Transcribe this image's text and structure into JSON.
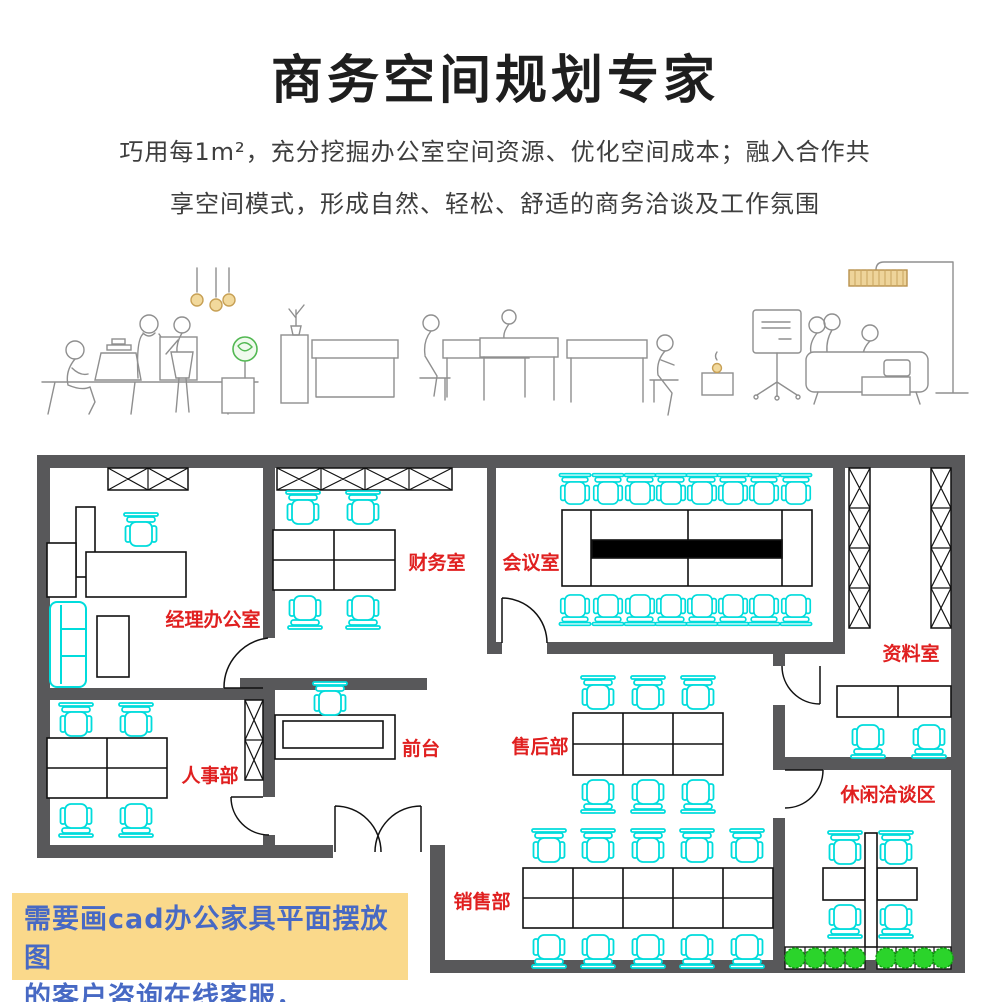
{
  "header": {
    "title": "商务空间规划专家",
    "subtitle_line1": "巧用每1m²，充分挖掘办公室空间资源、优化空间成本；融入合作共",
    "subtitle_line2": "享空间模式，形成自然、轻松、舒适的商务洽谈及工作氛围"
  },
  "floor_plan": {
    "rooms": {
      "manager": {
        "label": "经理办公室"
      },
      "finance": {
        "label": "财务室"
      },
      "meeting": {
        "label": "会议室"
      },
      "archive": {
        "label": "资料室"
      },
      "hr": {
        "label": "人事部"
      },
      "front_desk": {
        "label": "前台"
      },
      "after_sales": {
        "label": "售后部"
      },
      "lounge": {
        "label": "休闲洽谈区"
      },
      "sales": {
        "label": "销售部"
      }
    }
  },
  "note": {
    "line1": "需要画cad办公家具平面摆放图",
    "line2": "的客户咨询在线客服，"
  },
  "colors": {
    "wall_gray": "#58585a",
    "chair_cyan": "#00dcdc",
    "label_red": "#e02020",
    "plant_green": "#2bd42b",
    "note_bg": "#fad98b",
    "note_text": "#4769c4",
    "lamp_tan": "#f2d99c"
  }
}
